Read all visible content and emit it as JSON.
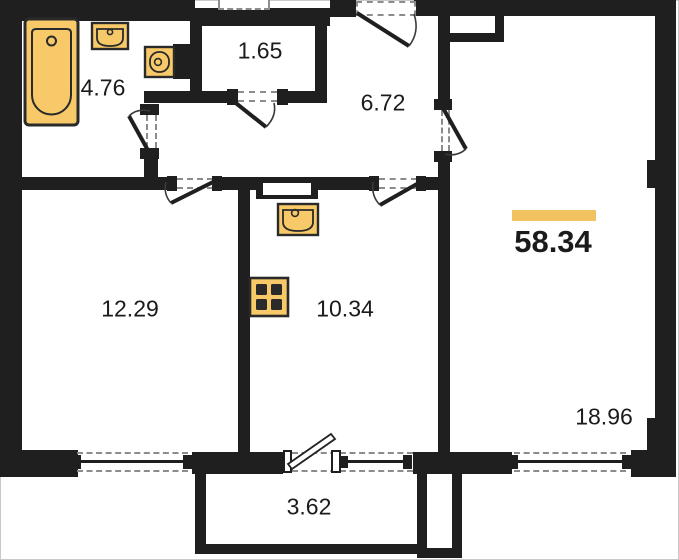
{
  "floor_plan": {
    "total_area": "58.34",
    "rooms": [
      {
        "id": "bathroom",
        "area": "4.76"
      },
      {
        "id": "wc",
        "area": "1.65"
      },
      {
        "id": "hallway",
        "area": "6.72"
      },
      {
        "id": "room",
        "area": "12.29"
      },
      {
        "id": "kitchen",
        "area": "10.34"
      },
      {
        "id": "living-room",
        "area": "18.96"
      },
      {
        "id": "balcony",
        "area": "3.62"
      }
    ],
    "fixtures": [
      "bathtub",
      "washbasin",
      "toilet",
      "kitchen-sink",
      "stove"
    ],
    "colors": {
      "wall": "#1F1F1F",
      "fixture-fill": "#F8C968",
      "fixture-stroke": "#2A2A2A",
      "accent-bar": "#F2C261",
      "text": "#1B1B1B",
      "dash": "#8C8C8C"
    }
  }
}
